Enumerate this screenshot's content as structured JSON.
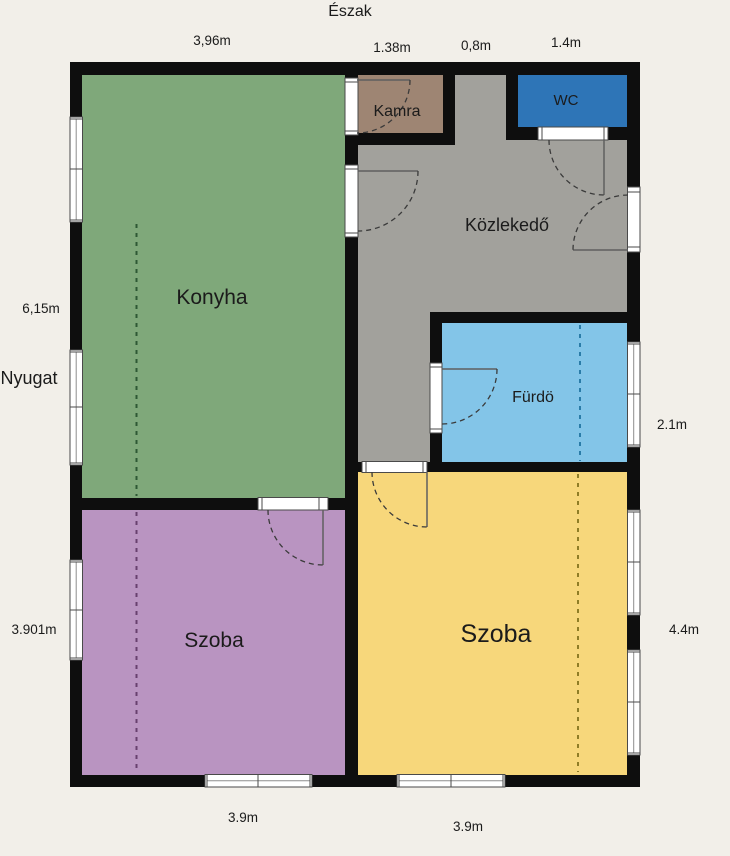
{
  "background_color": "#f2efe9",
  "wall_color": "#0e0e0e",
  "compass": {
    "north": "Észak",
    "west": "Nyugat"
  },
  "rooms": {
    "konyha": {
      "label": "Konyha",
      "color": "#7fa87a",
      "dash_color": "#2e5834"
    },
    "kamra": {
      "label": "Kamra",
      "color": "#9e8573"
    },
    "wc": {
      "label": "WC",
      "color": "#2e75b7"
    },
    "kozlekedo": {
      "label": "Közlekedő",
      "color": "#a2a19c"
    },
    "furdo": {
      "label": "Fürdö",
      "color": "#83c5e8",
      "dash_color": "#2a7ca8"
    },
    "szoba_purple": {
      "label": "Szoba",
      "color": "#b994c1",
      "dash_color": "#68406e"
    },
    "szoba_yellow": {
      "label": "Szoba",
      "color": "#f7d77b",
      "dash_color": "#8f7d26"
    }
  },
  "measurements": {
    "top": [
      "3,96m",
      "1.38m",
      "0,8m",
      "1.4m"
    ],
    "left": [
      "6,15m",
      "3.901m"
    ],
    "right": [
      "2.1m",
      "4.4m"
    ],
    "bottom": [
      "3.9m",
      "3.9m"
    ]
  }
}
